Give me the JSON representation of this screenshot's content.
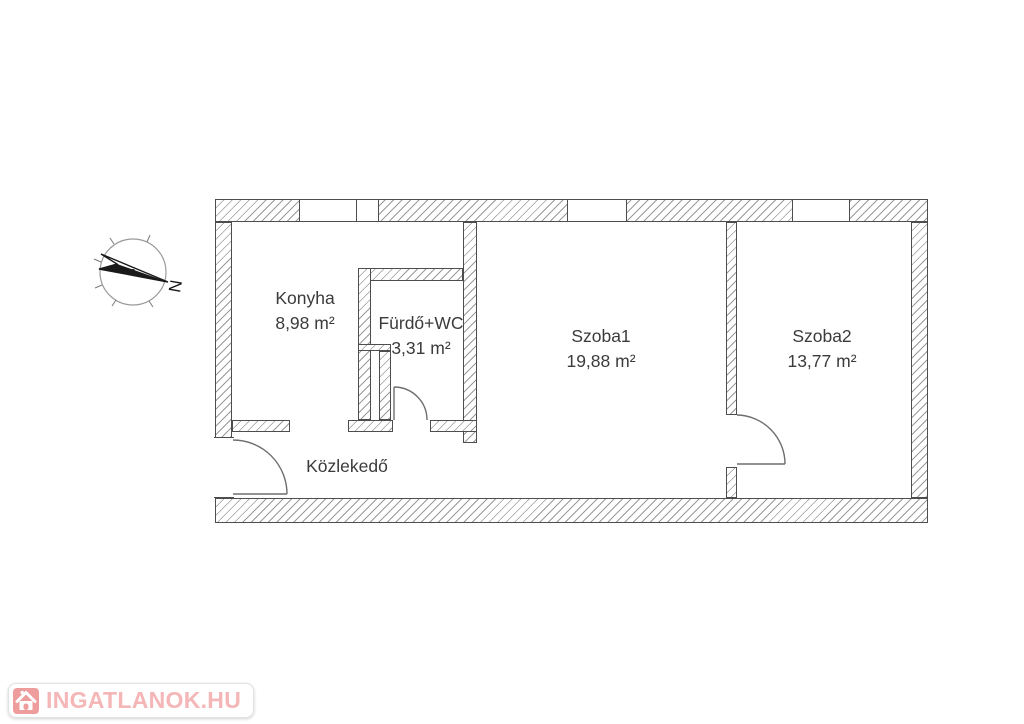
{
  "floorplan": {
    "rooms": [
      {
        "name": "Konyha",
        "area": "8,98 m²"
      },
      {
        "name": "Fürdő+WC",
        "area": "3,31 m²"
      },
      {
        "name": "Szoba1",
        "area": "19,88 m²"
      },
      {
        "name": "Szoba2",
        "area": "13,77 m²"
      },
      {
        "name": "Közlekedő",
        "area": ""
      }
    ],
    "compass": {
      "label": "N"
    },
    "colors": {
      "wall_outline": "#4d4d4d",
      "hatch_line": "#9a9a9a",
      "door_line": "#6e6e6e",
      "label_text": "#3b3b3b"
    }
  },
  "watermark": {
    "text": "INGATLANOK.HU",
    "text_color": "#f4b6b6",
    "icon": "house-icon",
    "icon_color": "#ee9d9d"
  }
}
